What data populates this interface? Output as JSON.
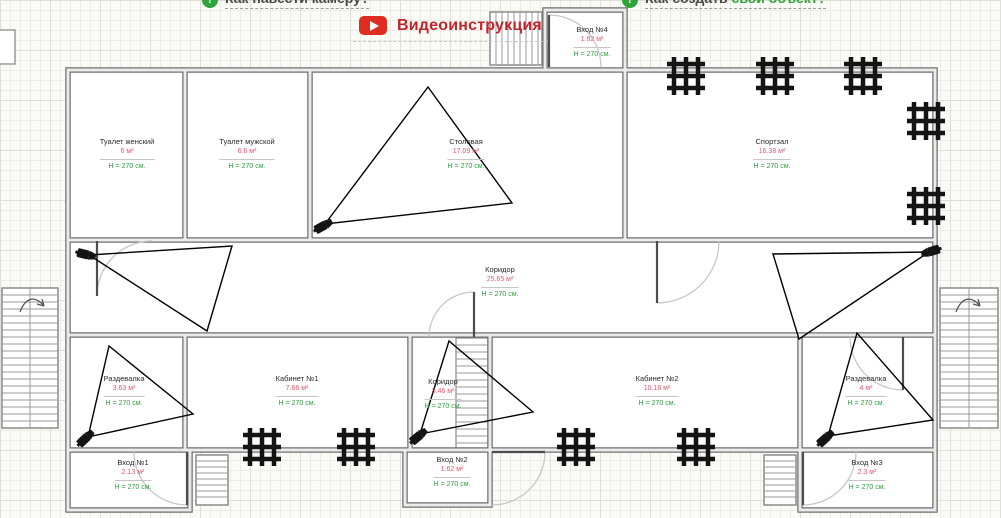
{
  "header": {
    "help_links": [
      {
        "label": "Как навести камеру?"
      },
      {
        "label_prefix": "Как создать ",
        "label_accent": "свой объект?"
      }
    ],
    "video_button_label": "Видеоинструкция"
  },
  "colors": {
    "area_text": "#e4566b",
    "height_text": "#2f9e3f",
    "video_red": "#c3242c",
    "help_green": "#2ea43a"
  },
  "rooms": [
    {
      "name": "Туалет женский",
      "area": "6 м²",
      "height": "H = 270 см."
    },
    {
      "name": "Туалет мужской",
      "area": "6.6 м²",
      "height": "H = 270 см."
    },
    {
      "name": "Столовая",
      "area": "17.09 м²",
      "height": "H = 270 см."
    },
    {
      "name": "Спортзал",
      "area": "16.38 м²",
      "height": "H = 270 см."
    },
    {
      "name": "Вход №4",
      "area": "1.82 м²",
      "height": "H = 270 см."
    },
    {
      "name": "Коридор",
      "area": "25.65 м²",
      "height": "H = 270 см."
    },
    {
      "name": "Раздевалка",
      "area": "3.63 м²",
      "height": "H = 270 см."
    },
    {
      "name": "Кабинет №1",
      "area": "7.66 м²",
      "height": "H = 270 см."
    },
    {
      "name": "Коридор",
      "area": "3.46 м²",
      "height": "H = 270 см."
    },
    {
      "name": "Кабинет №2",
      "area": "10.16 м²",
      "height": "H = 270 см."
    },
    {
      "name": "Раздевалка",
      "area": "4 м²",
      "height": "H = 270 см."
    },
    {
      "name": "Вход №1",
      "area": "2.13 м²",
      "height": "H = 270 см."
    },
    {
      "name": "Вход №2",
      "area": "1.62 м²",
      "height": "H = 270 см."
    },
    {
      "name": "Вход №3",
      "area": "2.3 м²",
      "height": "H = 270 см."
    }
  ]
}
